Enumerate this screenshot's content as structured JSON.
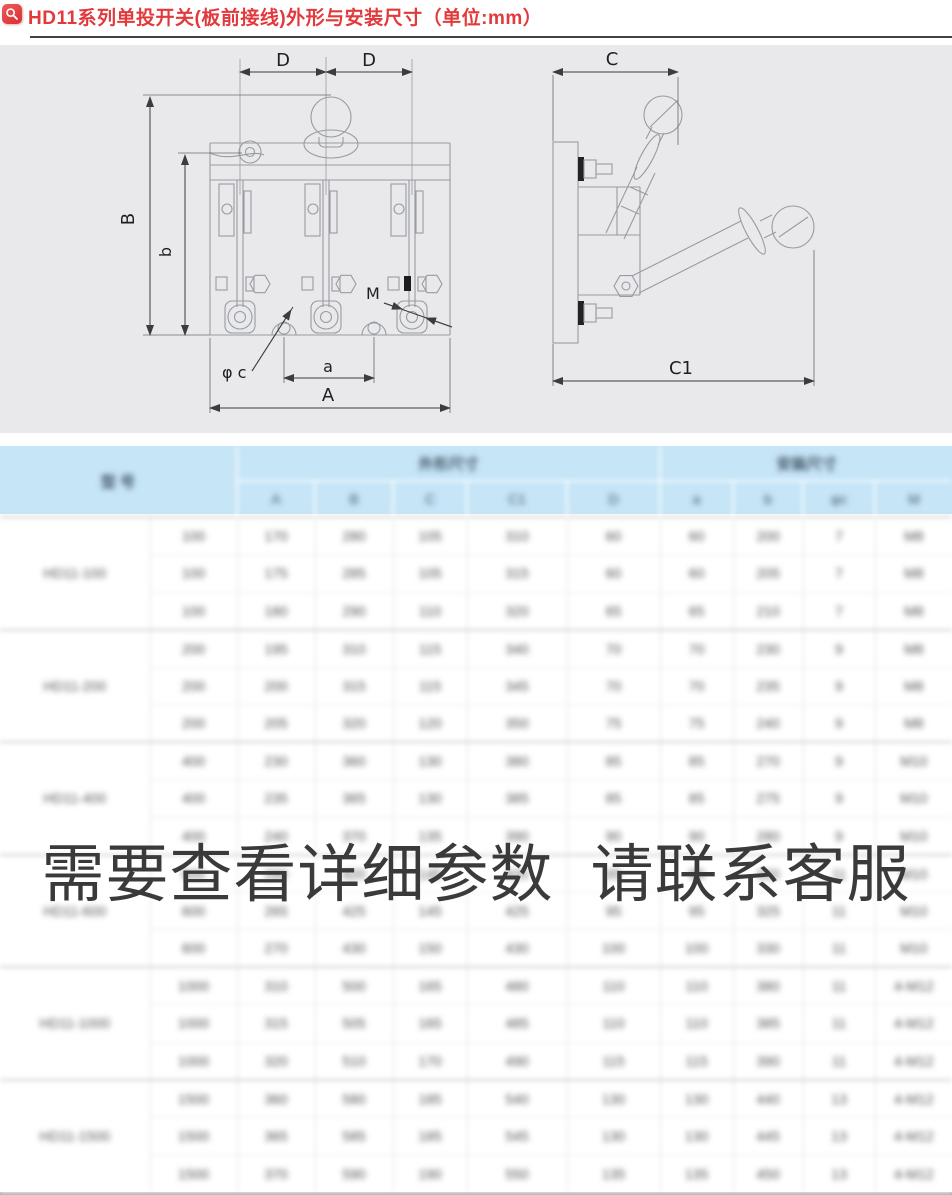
{
  "colors": {
    "accent_red": "#e23a3c",
    "header_blue": "#c6e5f7",
    "watermark_gray": "#3a3a3a",
    "diagram_bg": "#e9e9eb"
  },
  "header": {
    "icon": "magnifier-icon",
    "title": "HD11系列单投开关(板前接线)外形与安装尺寸（单位:mm）"
  },
  "diagram": {
    "labels": {
      "d_left": "D",
      "d_right": "D",
      "B": "B",
      "b": "b",
      "m": "M",
      "phi_c": "φ c",
      "a": "a",
      "A": "A",
      "c": "C",
      "c1": "C1"
    }
  },
  "watermark": {
    "text": "需要查看详细参数 请联系客服"
  },
  "table": {
    "blurred": true,
    "model_header": "型 号",
    "group_headers": [
      {
        "label": "外形尺寸",
        "span": 5
      },
      {
        "label": "安装尺寸",
        "span": 4
      }
    ],
    "sub_headers": [
      "A",
      "B",
      "C",
      "C1",
      "D",
      "a",
      "b",
      "φc",
      "M"
    ],
    "groups": [
      {
        "model": "HD11-100",
        "rows": [
          [
            "100",
            "170",
            "280",
            "105",
            "310",
            "60",
            "60",
            "200",
            "7",
            "M8"
          ],
          [
            "100",
            "175",
            "285",
            "105",
            "315",
            "60",
            "60",
            "205",
            "7",
            "M8"
          ],
          [
            "100",
            "180",
            "290",
            "110",
            "320",
            "65",
            "65",
            "210",
            "7",
            "M8"
          ]
        ]
      },
      {
        "model": "HD11-200",
        "rows": [
          [
            "200",
            "195",
            "310",
            "115",
            "340",
            "70",
            "70",
            "230",
            "9",
            "M8"
          ],
          [
            "200",
            "200",
            "315",
            "115",
            "345",
            "70",
            "70",
            "235",
            "9",
            "M8"
          ],
          [
            "200",
            "205",
            "320",
            "120",
            "350",
            "75",
            "75",
            "240",
            "9",
            "M8"
          ]
        ]
      },
      {
        "model": "HD11-400",
        "rows": [
          [
            "400",
            "230",
            "360",
            "130",
            "380",
            "85",
            "85",
            "270",
            "9",
            "M10"
          ],
          [
            "400",
            "235",
            "365",
            "130",
            "385",
            "85",
            "85",
            "275",
            "9",
            "M10"
          ],
          [
            "400",
            "240",
            "370",
            "135",
            "390",
            "90",
            "90",
            "280",
            "9",
            "M10"
          ]
        ]
      },
      {
        "model": "HD11-600",
        "rows": [
          [
            "600",
            "260",
            "420",
            "145",
            "420",
            "95",
            "95",
            "320",
            "11",
            "M10"
          ],
          [
            "600",
            "265",
            "425",
            "145",
            "425",
            "95",
            "95",
            "325",
            "11",
            "M10"
          ],
          [
            "600",
            "270",
            "430",
            "150",
            "430",
            "100",
            "100",
            "330",
            "11",
            "M10"
          ]
        ]
      },
      {
        "model": "HD11-1000",
        "rows": [
          [
            "1000",
            "310",
            "500",
            "165",
            "480",
            "110",
            "110",
            "380",
            "11",
            "4-M12"
          ],
          [
            "1000",
            "315",
            "505",
            "165",
            "485",
            "110",
            "110",
            "385",
            "11",
            "4-M12"
          ],
          [
            "1000",
            "320",
            "510",
            "170",
            "490",
            "115",
            "115",
            "390",
            "11",
            "4-M12"
          ]
        ]
      },
      {
        "model": "HD11-1500",
        "rows": [
          [
            "1500",
            "360",
            "580",
            "185",
            "540",
            "130",
            "130",
            "440",
            "13",
            "4-M12"
          ],
          [
            "1500",
            "365",
            "585",
            "185",
            "545",
            "130",
            "130",
            "445",
            "13",
            "4-M12"
          ],
          [
            "1500",
            "370",
            "590",
            "190",
            "550",
            "135",
            "135",
            "450",
            "13",
            "4-M12"
          ]
        ]
      }
    ]
  }
}
